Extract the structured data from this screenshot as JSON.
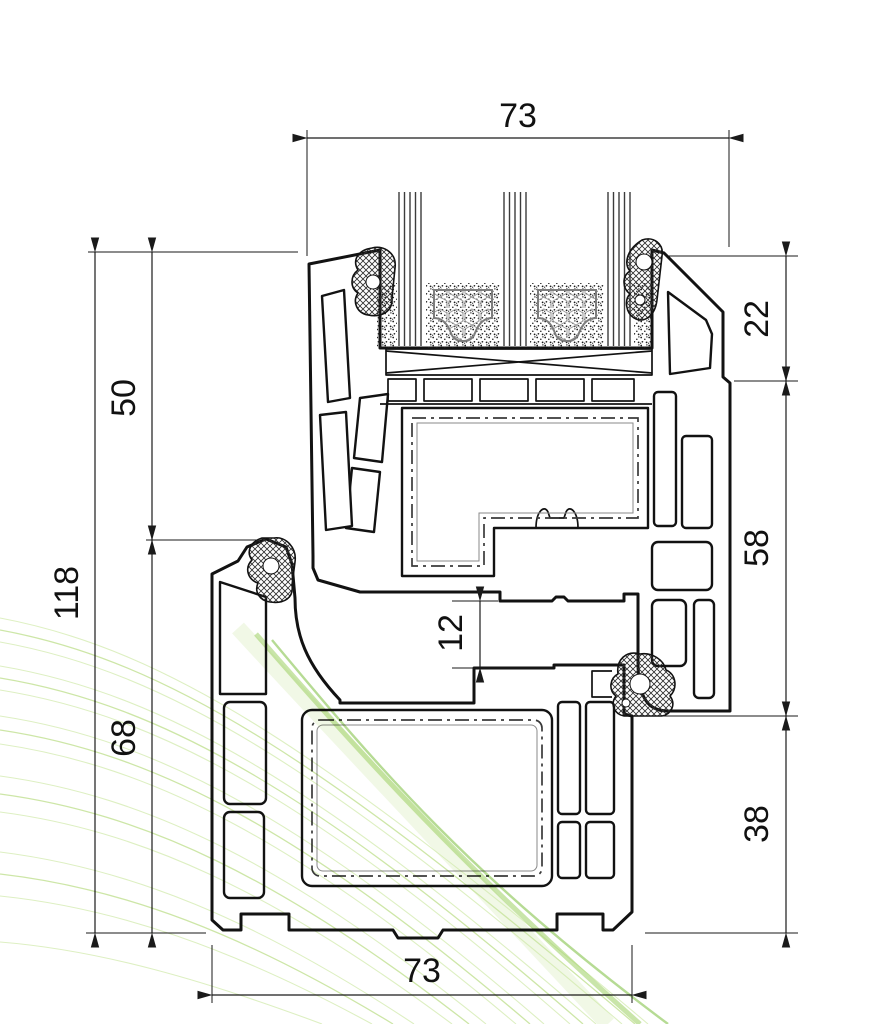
{
  "drawing": {
    "dimensions": {
      "top_width": "73",
      "bottom_width": "73",
      "overall_height": "118",
      "upper_height": "50",
      "lower_height": "68",
      "right_top": "22",
      "right_middle": "58",
      "right_bottom": "38",
      "rebate_gap": "12"
    },
    "palette": {
      "line": "#1a1a1a",
      "background": "#ffffff",
      "swirl_light": "#dcefbf",
      "swirl_mid": "#c8e49e",
      "swirl_dark": "#85c34c"
    }
  }
}
